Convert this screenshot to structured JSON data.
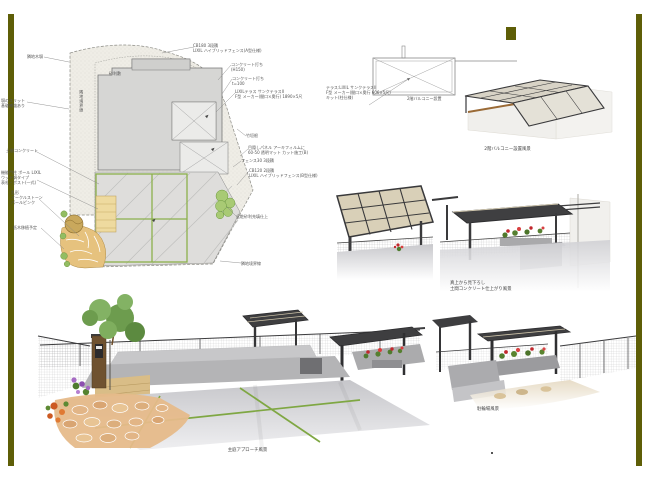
{
  "colors": {
    "accent": "#5e5e07",
    "plan_green": "#8cb14c",
    "frame_dark": "#3a3a3c",
    "flower_red": "#c1272d"
  },
  "plan": {
    "annotations": [
      {
        "lines": [
          "CB180 3段積",
          "LIXIL ハイブリッドフェンス(A型仕様)"
        ]
      },
      {
        "lines": [
          "コンクリート打ち",
          "(H150)"
        ]
      },
      {
        "lines": [
          "コンクリート打ち",
          "t=100"
        ]
      },
      {
        "lines": [
          "LIXILテラス サンクテラスII",
          "F型 メーカー(間口×奥行) 1890×5尺"
        ]
      },
      {
        "lines": [
          "竹垣根"
        ]
      },
      {
        "lines": [
          "目隠しパネル アーキフィルムに",
          "60-50 透明マット カット施工(B)"
        ]
      },
      {
        "lines": [
          "フェンス30 3段積"
        ]
      },
      {
        "lines": [
          "CB120 2段積",
          "LIXIL ハイブリッドフェンス(B型仕様)"
        ]
      },
      {
        "lines": [
          "化粧砂利充填仕上"
        ]
      },
      {
        "lines": [
          "隣地境界線"
        ]
      },
      {
        "lines": [
          "隣地木塀"
        ]
      },
      {
        "lines": [
          "塀のスリット",
          "基礎補強あり"
        ]
      },
      {
        "lines": [
          "土間コンクリート"
        ]
      },
      {
        "lines": [
          "機能門柱 ポール LIXIL",
          "ウッド調タイプ",
          "表札・ポスト(一式)"
        ]
      },
      {
        "lines": [
          "乱形",
          "オークルストーン",
          "パールピンク"
        ]
      },
      {
        "lines": [
          "低木移植予定"
        ]
      },
      {
        "lines": [
          "砂利敷"
        ]
      },
      {
        "lines": [
          "隣地境界線"
        ]
      }
    ]
  },
  "balcony": {
    "spec_lines": [
      "テラス:LIXIL サンクテラスII",
      "F型 メーカー(間口×奥行 606×5尺)",
      "キット(柱仕様)"
    ],
    "plan_label": "2階バルコニー設置",
    "render_caption": "2階バルコニー設置風景"
  },
  "terrace_views": {
    "caption_lines": [
      "真上から見下ろし",
      "土間コンクリート仕上がり風景"
    ]
  },
  "garden_view": {
    "caption": "主庭アプローチ風景"
  },
  "bike_view": {
    "caption": "駐輪場風景"
  }
}
